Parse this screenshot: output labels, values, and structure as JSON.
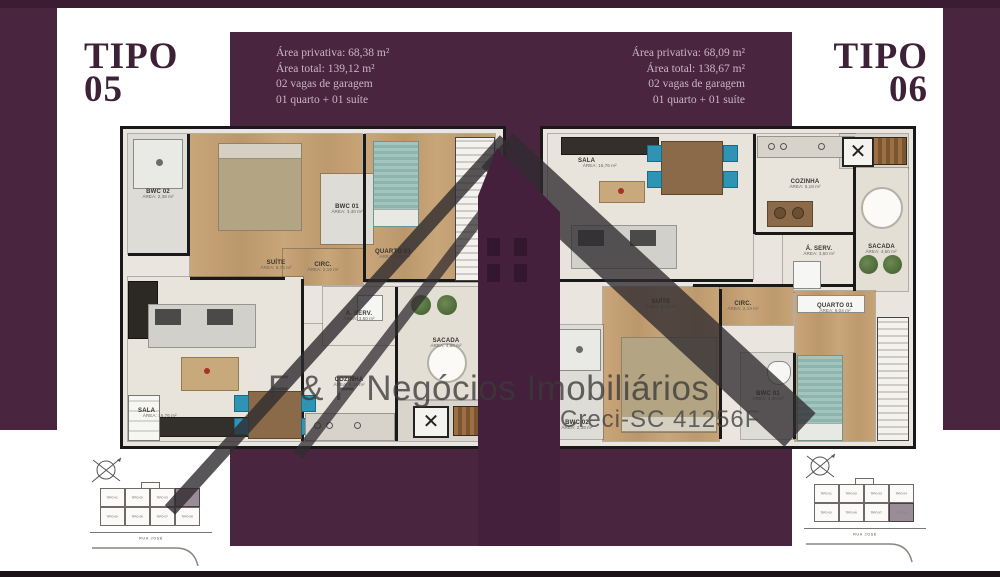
{
  "colors": {
    "maroon_panel": "#4a2540",
    "maroon_bar": "#3a1c33",
    "title_text": "#3d2137",
    "panel_text": "#c9b4c4",
    "watermark_gray": "#3a3a3a",
    "plan_floor": "#eae6df",
    "wall": "#191919",
    "wood_floor": "#c3a077",
    "teal_bed": "#8fb8ae",
    "highlight_unit": "#9b8d98"
  },
  "tipo05": {
    "title_line1": "TIPO",
    "title_line2": "05",
    "specs": [
      "Área privativa: 68,38 m²",
      "Área total: 139,12 m²",
      "02 vagas de garagem",
      "01 quarto + 01 suíte"
    ],
    "rooms": {
      "bwc02": {
        "name": "BWC 02",
        "area": "ÁREA: 2,38 m²"
      },
      "suite": {
        "name": "SUÍTE",
        "area": "ÁREA: 8,76 m²"
      },
      "bwc01": {
        "name": "BWC 01",
        "area": "ÁREA: 3,40 m²"
      },
      "quarto01": {
        "name": "QUARTO 01",
        "area": "ÁREA: 9,04 m²"
      },
      "circ": {
        "name": "CIRC.",
        "area": "ÁREA: 2,19 m²"
      },
      "sala": {
        "name": "SALA",
        "area": "ÁREA: 16,76 m²"
      },
      "cozinha": {
        "name": "COZINHA",
        "area": "ÁREA: 5,18 m²"
      },
      "aserv": {
        "name": "Á. SERV.",
        "area": "ÁREA: 3,50 m²"
      },
      "sacada": {
        "name": "SACADA",
        "area": "ÁREA: 4,60 m²"
      }
    }
  },
  "tipo06": {
    "title_line1": "TIPO",
    "title_line2": "06",
    "specs": [
      "Área privativa: 68,09 m²",
      "Área total: 138,67 m²",
      "02 vagas de garagem",
      "01 quarto + 01 suíte"
    ],
    "rooms": {
      "sala": {
        "name": "SALA",
        "area": "ÁREA: 16,76 m²"
      },
      "cozinha": {
        "name": "COZINHA",
        "area": "ÁREA: 5,18 m²"
      },
      "aserv": {
        "name": "Á. SERV.",
        "area": "ÁREA: 3,50 m²"
      },
      "sacada": {
        "name": "SACADA",
        "area": "ÁREA: 4,60 m²"
      },
      "circ": {
        "name": "CIRC.",
        "area": "ÁREA: 2,19 m²"
      },
      "suite": {
        "name": "SUÍTE",
        "area": "ÁREA: 8,76 m²"
      },
      "bwc02": {
        "name": "BWC 02",
        "area": "ÁREA: 2,38 m²"
      },
      "bwc01": {
        "name": "BWC 01",
        "area": "ÁREA: 3,40 m²"
      },
      "quarto01": {
        "name": "QUARTO 01",
        "area": "ÁREA: 9,04 m²"
      }
    }
  },
  "watermark": {
    "company": "F & F Negócios Imobiliários",
    "license": "Creci-SC 41256F"
  },
  "siteplan": {
    "street": "RUA JOSÉ",
    "units": [
      "TIPO 01",
      "TIPO 02",
      "TIPO 03",
      "TIPO 04",
      "TIPO 05",
      "TIPO 06",
      "TIPO 07",
      "TIPO 08"
    ]
  }
}
